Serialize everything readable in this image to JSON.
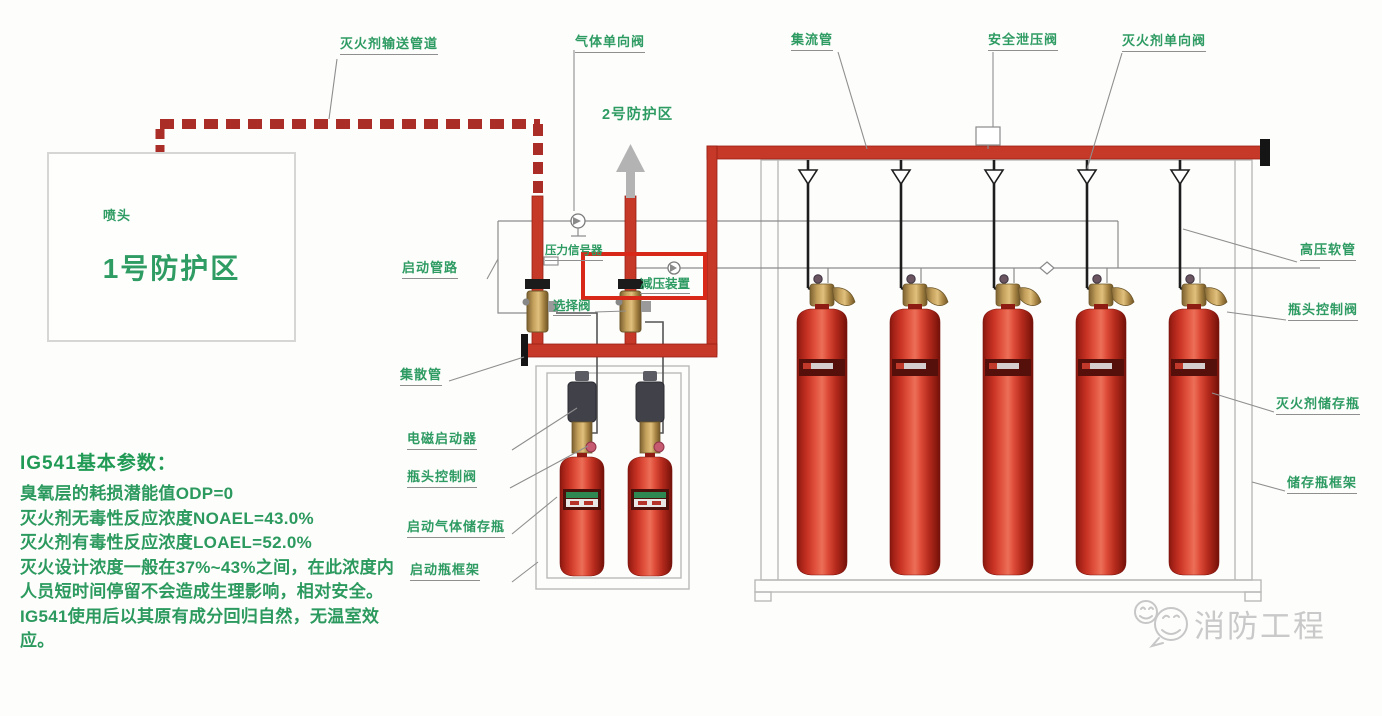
{
  "labels": {
    "delivery_pipe": "灭火剂输送管道",
    "gas_check_valve": "气体单向阀",
    "manifold": "集流管",
    "safety_relief_valve": "安全泄压阀",
    "agent_check_valve": "灭火剂单向阀",
    "high_pressure_hose": "高压软管",
    "head_valve_right": "瓶头控制阀",
    "agent_bottle": "灭火剂储存瓶",
    "storage_frame": "储存瓶框架",
    "start_pipeline": "启动管路",
    "selector_valve": "选择阀",
    "collector_pipe": "集散管",
    "solenoid_actuator": "电磁启动器",
    "head_valve_left": "瓶头控制阀",
    "start_gas_bottle": "启动气体储存瓶",
    "start_frame": "启动瓶框架",
    "pressure_signal": "压力信号器",
    "pressure_reducer": "减压装置",
    "nozzle": "喷头"
  },
  "zones": {
    "zone1": "1号防护区",
    "zone2": "2号防护区"
  },
  "info_panel": {
    "title": "IG541基本参数：",
    "lines": [
      "臭氧层的耗损潜能值ODP=0",
      "灭火剂无毒性反应浓度NOAEL=43.0%",
      "灭火剂有毒性反应浓度LOAEL=52.0%",
      "灭火设计浓度一般在37%~43%之间，在此浓度内人员短时间停留不会造成生理影响，相对安全。",
      "IG541使用后以其原有成分回归自然，无温室效应。"
    ]
  },
  "watermark": {
    "text": "消防工程"
  },
  "counts": {
    "agent_cylinders": 5,
    "starter_cylinders": 2,
    "nozzles": 2
  },
  "colors": {
    "label_green": "#2e9b62",
    "pipe_red": "#c63827",
    "dashed_pipe_red": "#aa2d28",
    "highlight_red": "#d8281a",
    "cylinder_red": "#ca3425",
    "frame_gray": "#b9b9b9",
    "watermark_gray": "#c9c9c9"
  }
}
